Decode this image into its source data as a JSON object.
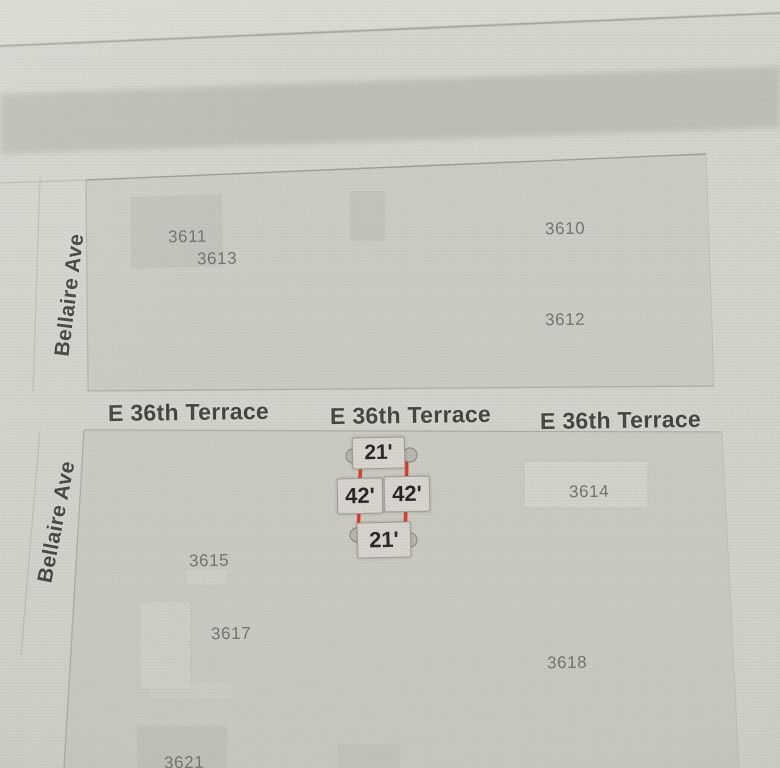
{
  "app": {
    "description": "parcel map with distance measurement"
  },
  "streets": {
    "bellaire": {
      "name": "Bellaire Ave",
      "labels": [
        "Bellaire Ave",
        "Bellaire Ave"
      ]
    },
    "e36th": {
      "name": "E 36th Terrace",
      "labels": [
        "E 36th Terrace",
        "E 36th Terrace",
        "E 36th Terrace"
      ]
    }
  },
  "parcels": [
    {
      "number": "3611"
    },
    {
      "number": "3613"
    },
    {
      "number": "3610"
    },
    {
      "number": "3612"
    },
    {
      "number": "3614"
    },
    {
      "number": "3615"
    },
    {
      "number": "3617"
    },
    {
      "number": "3618"
    },
    {
      "number": "3621"
    }
  ],
  "measurement": {
    "top_width": "21'",
    "left_depth": "42'",
    "right_depth": "42'",
    "bottom_width": "21'"
  },
  "colors": {
    "accent_red": "#d8382c",
    "map_bg": "#d5d4cc",
    "block_fill": "#cdccc4",
    "street_label": "#3f3f3a",
    "parcel_label": "#70706b",
    "box_fill": "#d9d7cf",
    "box_border": "#9e9d96",
    "box_text": "#1e1e1c",
    "handle_fill": "#b9b8b1",
    "handle_stroke": "#8d8c85"
  }
}
